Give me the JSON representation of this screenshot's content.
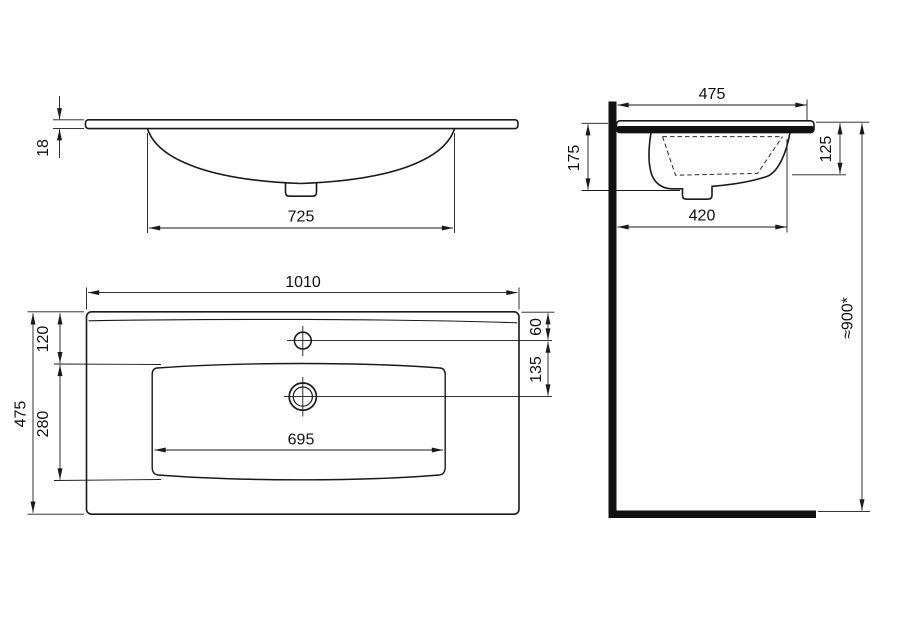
{
  "drawing": {
    "front_view": {
      "slab_thickness": "18",
      "basin_opening_width": "725"
    },
    "side_view": {
      "overall_depth": "475",
      "front_height": "175",
      "basin_inner_depth": "125",
      "basin_outer_extent": "420",
      "installation_height": "≈900*"
    },
    "plan_view": {
      "overall_width": "1010",
      "overall_depth": "475",
      "edge_to_basin": "120",
      "basin_depth": "280",
      "faucet_hole_offset": "60",
      "faucet_to_drain": "135",
      "basin_inner_width": "695"
    }
  },
  "colors": {
    "line": "#1a1a1a",
    "background": "#ffffff"
  }
}
